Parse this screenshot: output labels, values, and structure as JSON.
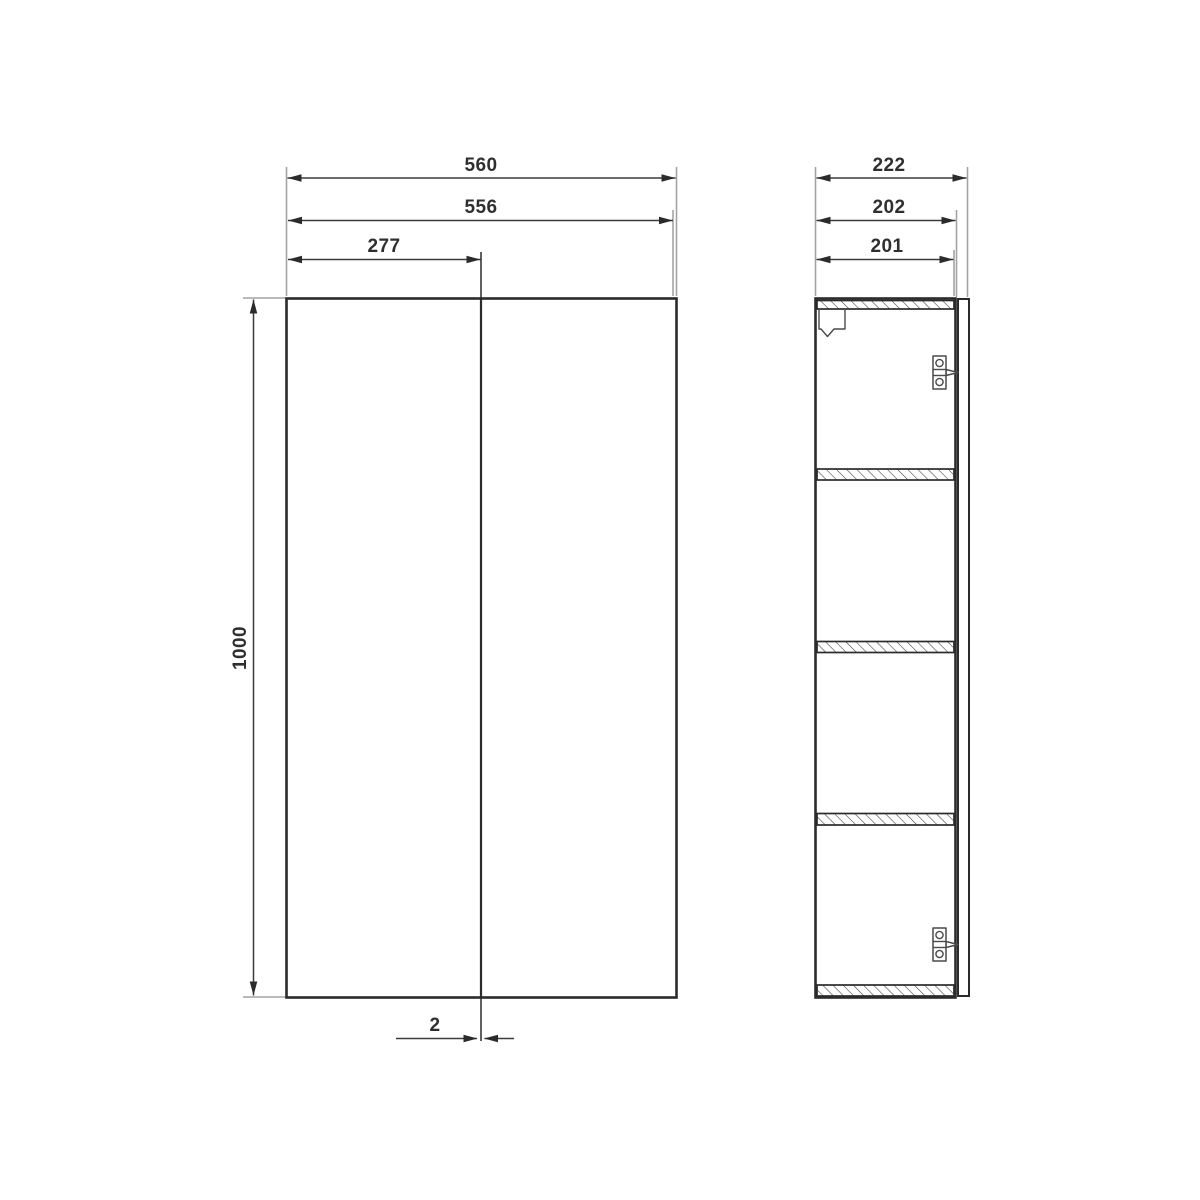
{
  "drawing_type": "cabinet-technical-drawing",
  "front_view": {
    "dimensions": {
      "overall_width": "560",
      "front_width": "556",
      "left_door_center": "277",
      "height": "1000",
      "door_gap": "2"
    }
  },
  "side_view": {
    "dimensions": {
      "overall_depth": "222",
      "carcass_depth": "202",
      "inner_depth": "201"
    },
    "shelf_count": 3
  },
  "colors": {
    "line": "#2b2b2b",
    "dimension_line": "#3c3c3c",
    "extension_line": "#a3a3a3",
    "background": "#ffffff"
  }
}
